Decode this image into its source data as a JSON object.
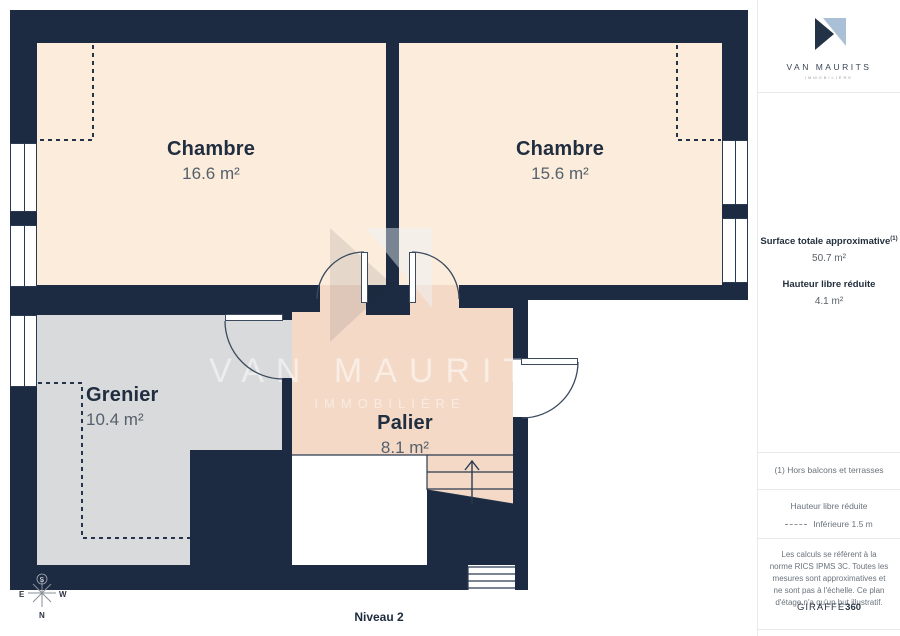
{
  "plan": {
    "floor_label": "Niveau 2",
    "rooms": [
      {
        "name": "Chambre",
        "area": "16.6 m²"
      },
      {
        "name": "Chambre",
        "area": "15.6 m²"
      },
      {
        "name": "Grenier",
        "area": "10.4 m²"
      },
      {
        "name": "Palier",
        "area": "8.1 m²"
      }
    ],
    "compass": {
      "top": "S",
      "left": "E",
      "right": "W",
      "bottom": "N"
    },
    "watermark": {
      "title": "VAN MAURITS",
      "subtitle": "IMMOBILIÈRE"
    }
  },
  "sidebar": {
    "logo": {
      "title": "VAN MAURITS",
      "subtitle": "IMMOBILIÈRE"
    },
    "summary": {
      "surface_label": "Surface totale approximative",
      "surface_footnote_marker": "(1)",
      "surface_value": "50.7 m²",
      "height_label": "Hauteur libre réduite",
      "height_value": "4.1 m²"
    },
    "footnote": "(1) Hors balcons et terrasses",
    "legend": {
      "title": "Hauteur libre réduite",
      "item_label": "Inférieure 1.5 m"
    },
    "disclaimer": "Les calculs se réfèrent à la norme RICS IPMS 3C. Toutes les mesures sont approximatives et ne sont pas à l'échelle. Ce plan d'étage n'a qu'un but illustratif.",
    "brand": {
      "name": "GIRAFFE",
      "suffix": "360"
    }
  },
  "colors": {
    "wall": "#1c2b41",
    "room_chambre": "#fcecdc",
    "room_palier": "#f4d9c7",
    "room_grenier": "#d9dadc",
    "logo_navy": "#233247",
    "logo_blue": "#a9c0d6"
  }
}
